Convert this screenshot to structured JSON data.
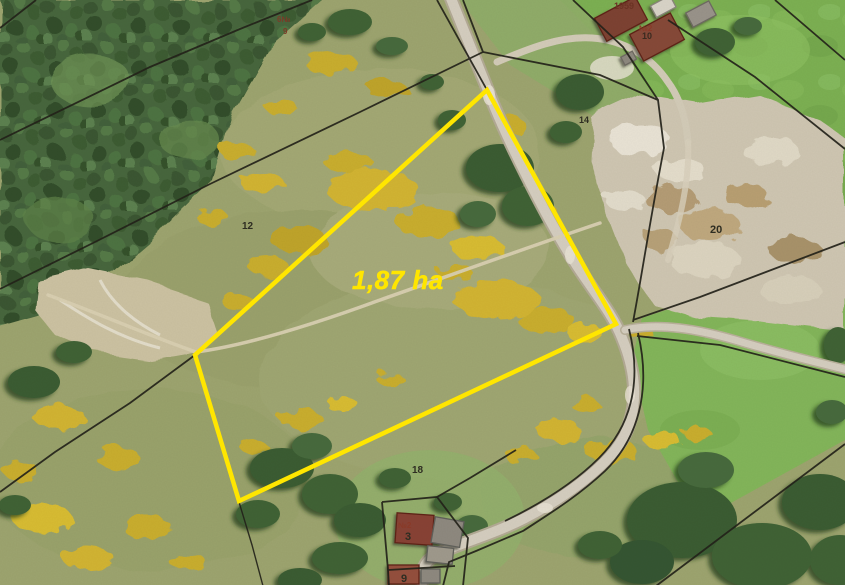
{
  "map": {
    "kind": "aerial-cadastral-map",
    "colors": {
      "highlight": "#ffe600",
      "boundary": "#23221a",
      "label_dark": "#2e2d22",
      "label_red": "#7c3a28"
    },
    "highlight": {
      "area_label": "1,87 ha",
      "area_label_pos": [
        352,
        289
      ],
      "area_label_font_size": 26,
      "stroke_width": 4.5,
      "vertices": [
        [
          487,
          90
        ],
        [
          616,
          324
        ],
        [
          239,
          501
        ],
        [
          195,
          355
        ]
      ]
    },
    "labels": [
      {
        "text": "12",
        "x": 242,
        "y": 229,
        "size": 10,
        "color": "#2e2d22"
      },
      {
        "text": "14",
        "x": 579,
        "y": 123,
        "size": 9,
        "color": "#2e2d22"
      },
      {
        "text": "20",
        "x": 710,
        "y": 233,
        "size": 11,
        "color": "#2e2d22"
      },
      {
        "text": "18",
        "x": 412,
        "y": 473,
        "size": 10,
        "color": "#2e2d22"
      },
      {
        "text": "3",
        "x": 405,
        "y": 540,
        "size": 11,
        "color": "#2e2d22"
      },
      {
        "text": "9",
        "x": 401,
        "y": 582,
        "size": 11,
        "color": "#2e2d22"
      },
      {
        "text": "10",
        "x": 642,
        "y": 39,
        "size": 9,
        "color": "#3a2a20"
      },
      {
        "text": "1959",
        "x": 614,
        "y": 9,
        "size": 9,
        "color": "#6b3324"
      },
      {
        "text": "№2",
        "x": 639,
        "y": 31,
        "size": 8,
        "color": "#8a3a28"
      },
      {
        "text": "№2",
        "x": 398,
        "y": 528,
        "size": 8,
        "color": "#8a3a28"
      },
      {
        "text": "6№",
        "x": 277,
        "y": 22,
        "size": 8,
        "color": "#7c3a28"
      },
      {
        "text": "9",
        "x": 283,
        "y": 34,
        "size": 8,
        "color": "#7c3a28"
      }
    ]
  }
}
